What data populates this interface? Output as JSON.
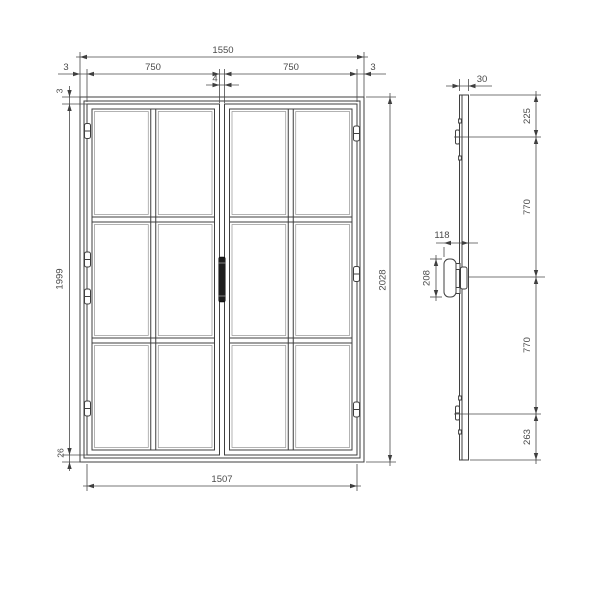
{
  "dims": {
    "front": {
      "total_width": "1550",
      "gap_left": "3",
      "leaf_width_left": "750",
      "center_gap": "4",
      "leaf_width_right": "750",
      "gap_right": "3",
      "gap_top": "3",
      "leaf_height": "1999",
      "gap_bottom": "26",
      "frame_height": "2028",
      "bottom_width": "1507"
    },
    "side": {
      "profile_depth": "30",
      "top_to_hinge": "225",
      "hinge_to_handle": "770",
      "handle_to_hinge": "770",
      "hinge_to_bottom": "263",
      "handle_projection": "118",
      "handle_length": "208"
    }
  },
  "colors": {
    "line": "#3f3f3f",
    "dim_text": "#4a4a4a",
    "handle_fill": "#1c1c1c",
    "background": "#ffffff"
  }
}
